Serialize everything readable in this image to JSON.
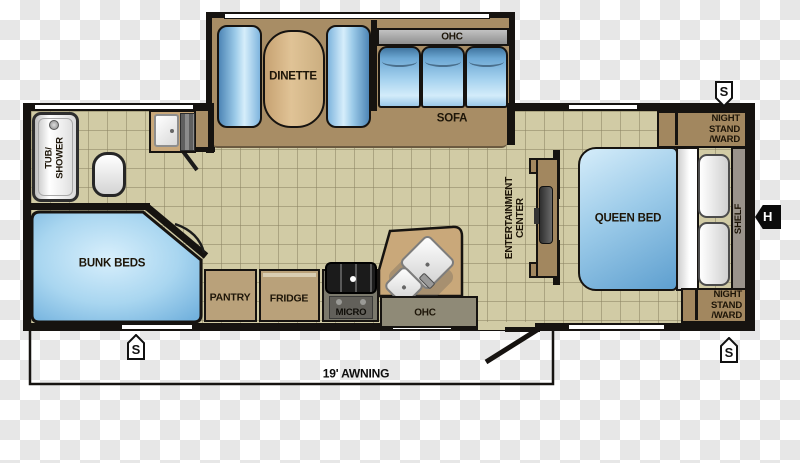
{
  "floorplan": {
    "slide_out": {
      "dinette_label": "DINETTE",
      "sofa_label": "SOFA",
      "sofa_ohc_label": "OHC"
    },
    "bathroom": {
      "tub_line1": "TUB/",
      "tub_line2": "SHOWER"
    },
    "bunk_room": {
      "label": "BUNK BEDS"
    },
    "kitchen": {
      "pantry_label": "PANTRY",
      "fridge_label": "FRIDGE",
      "micro_label": "MICRO",
      "ohc_label": "OHC"
    },
    "living": {
      "entertainment_line1": "ENTERTAINMENT",
      "entertainment_line2": "CENTER"
    },
    "bedroom": {
      "queen_bed_label": "QUEEN BED",
      "shelf_label": "SHELF",
      "nightstand_line1": "NIGHT",
      "nightstand_line2": "STAND",
      "nightstand_line3": "/WARD"
    },
    "awning": {
      "label": "19' AWNING"
    },
    "badges": {
      "stabilizer": "S",
      "hookup": "H"
    },
    "colors": {
      "wall": "#161310",
      "floor_tile": "#d1cba5",
      "slide_floor": "#a88d65",
      "furniture_blue": "#7db9e2",
      "cabinet_tan": "#a2875f",
      "counter_tan": "#c9a87a",
      "label_text": "#1d1508",
      "window": "#ffffff"
    }
  }
}
